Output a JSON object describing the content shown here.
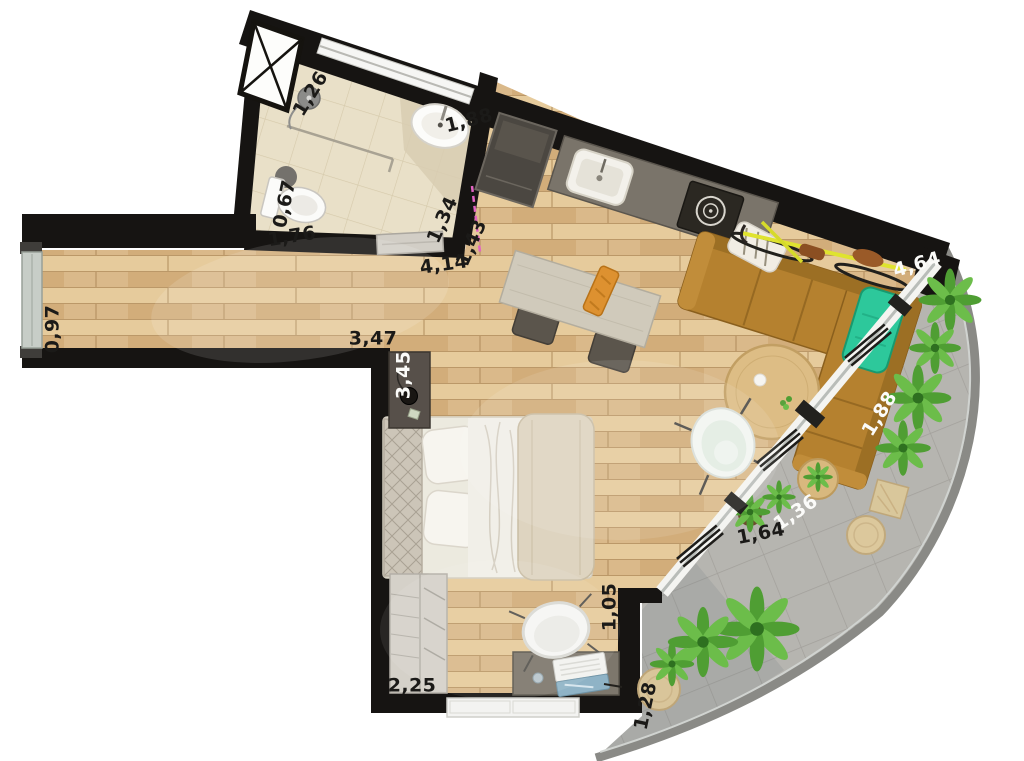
{
  "plan": {
    "kind": "apartment floor plan, top-down render",
    "dimension_labels": [
      {
        "text": "1,26",
        "tone": "dark"
      },
      {
        "text": "1,88",
        "tone": "dark"
      },
      {
        "text": "0,67",
        "tone": "dark"
      },
      {
        "text": "1,76",
        "tone": "dark"
      },
      {
        "text": "1,34",
        "tone": "dark"
      },
      {
        "text": "1,43",
        "tone": "dark"
      },
      {
        "text": "4,14",
        "tone": "dark"
      },
      {
        "text": "0,97",
        "tone": "dark"
      },
      {
        "text": "3,47",
        "tone": "dark"
      },
      {
        "text": "3,45",
        "tone": "light"
      },
      {
        "text": "4,64",
        "tone": "light"
      },
      {
        "text": "1,88",
        "tone": "light"
      },
      {
        "text": "1,36",
        "tone": "light"
      },
      {
        "text": "1,64",
        "tone": "dark"
      },
      {
        "text": "1,05",
        "tone": "dark"
      },
      {
        "text": "2,25",
        "tone": "dark"
      },
      {
        "text": "1,28",
        "tone": "dark"
      }
    ],
    "colors": {
      "wall": "#161412",
      "wood_floor": "#ddbf90",
      "bathroom_tile": "#e9e0c8",
      "balcony_floor": "#b6b5b0",
      "sofa_leather": "#b5812f",
      "coffee_table_wood": "#ddbd85",
      "bedding_white": "#eceadf",
      "throw_blanket": "#ded4c0",
      "plant_green": "#4f9e33",
      "teal_bag": "#2dc89b",
      "bike_yellow": "#dfe32f",
      "label_dark": "#1b1a18",
      "label_light": "#fbfbf9",
      "door_swing_pink": "#e263c2"
    },
    "fixtures": [
      "ventilation-shaft",
      "shower",
      "washbasin",
      "toilet",
      "bathroom-sliding-door",
      "hallway-window",
      "fridge",
      "kitchen-counter-with-sink-and-hob",
      "dining-table",
      "dining-chairs",
      "corner-sofa",
      "bicycle",
      "teal-bag",
      "coffee-table",
      "side-table",
      "egg-chair",
      "double-bed",
      "nightstand-with-lamp",
      "wardrobe",
      "desk-with-laptop",
      "desk-chair",
      "radiator-window",
      "balcony-glazing",
      "balcony-plants",
      "wicker-stools",
      "wicker-chair",
      "potted-plants"
    ]
  }
}
